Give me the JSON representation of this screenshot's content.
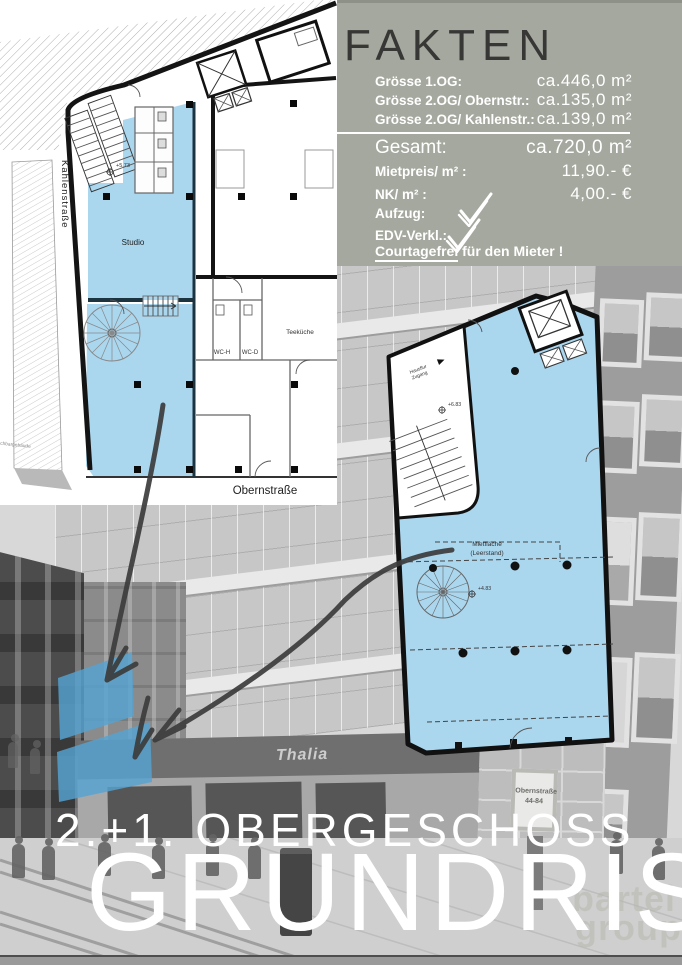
{
  "fakten": {
    "title": "FAKTEN",
    "rows": [
      {
        "label": "Grösse 1.OG:",
        "value": "ca.446,0  m²"
      },
      {
        "label": "Grösse 2.OG/ Obernstr.:",
        "value": "ca.135,0  m²"
      },
      {
        "label": "Grösse 2.OG/ Kahlenstr.:",
        "value": "ca.139,0  m²"
      }
    ],
    "total": {
      "label": "Gesamt:",
      "value": "ca.720,0  m²"
    },
    "price_rows": [
      {
        "label": "Mietpreis/ m² :",
        "value": "11,90.- €"
      },
      {
        "label": "NK/ m² :",
        "value": "4,00.- €"
      }
    ],
    "check_rows": [
      {
        "label": "Aufzug:"
      },
      {
        "label": "EDV-Verkl.:"
      }
    ],
    "courtage": {
      "highlight": "Courtagefrei",
      "rest": " für den Mieter !"
    }
  },
  "left_plan": {
    "street_left": "Kahlenstraße",
    "street_bottom": "Obernstraße",
    "room": "Studio",
    "wc_h": "WC-H",
    "wc_d": "WC-D",
    "kitchen": "Teeküche",
    "neighbor": "Nachbargebäude",
    "level": "+5.73"
  },
  "right_plan": {
    "area_line1": "Mietfläche",
    "area_line2": "(Leerstand)",
    "entry_line1": "Hausflur",
    "entry_line2": "Zugang",
    "level_top": "+6.83",
    "level_mid": "+4.83"
  },
  "photo": {
    "shop_sign": "Thalia",
    "street_sign_line1": "Obernstraße",
    "street_sign_line2": "44-84",
    "watermark_line1": "bartel",
    "watermark_line2": "group"
  },
  "footer": {
    "line1": "2.+1. OBERGESCHOSS",
    "line2": "GRUNDRISS"
  },
  "colors": {
    "plan_blue": "#aad6ee",
    "facade_blue": "#55a4d2",
    "panel_bg": "#a5a89e"
  }
}
